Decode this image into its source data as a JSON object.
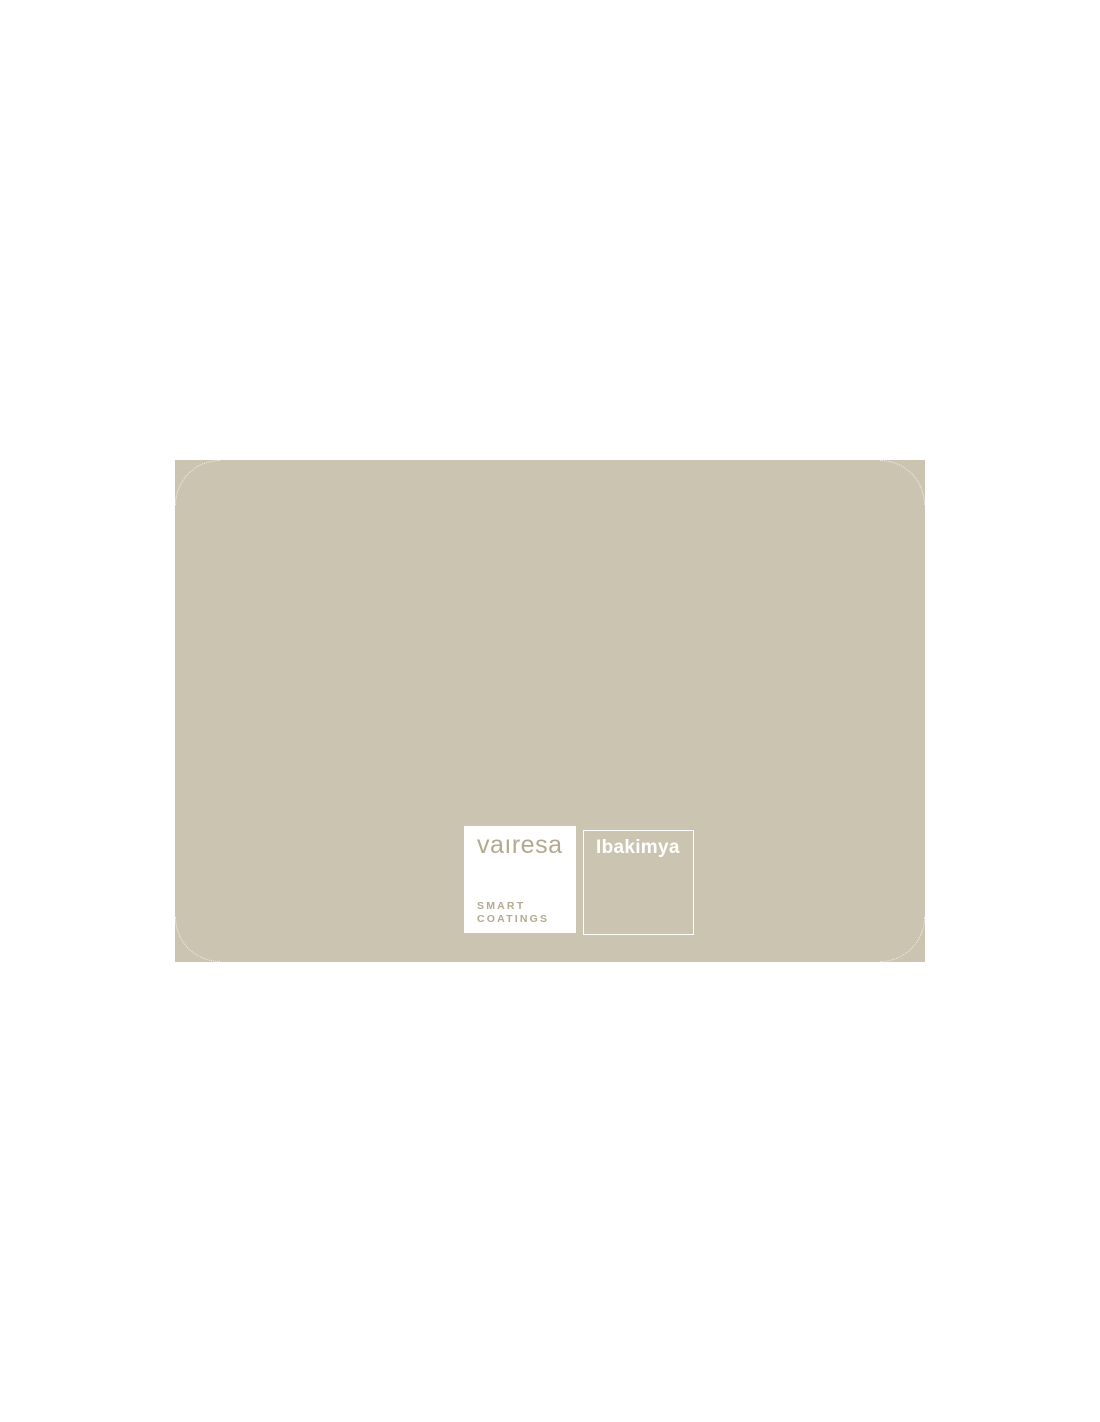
{
  "page": {
    "background_color": "#ffffff"
  },
  "swatch_card": {
    "color_name": "Ibakimya",
    "swatch_color": "#cbc4b1",
    "name_box_border_color": "#ffffff",
    "name_text_color": "#ffffff"
  },
  "brand": {
    "logo_text": "vaıresa",
    "tagline_line1": "SMART",
    "tagline_line2": "COATINGS",
    "logo_color": "#b3a98e",
    "logo_box_background": "#ffffff"
  }
}
